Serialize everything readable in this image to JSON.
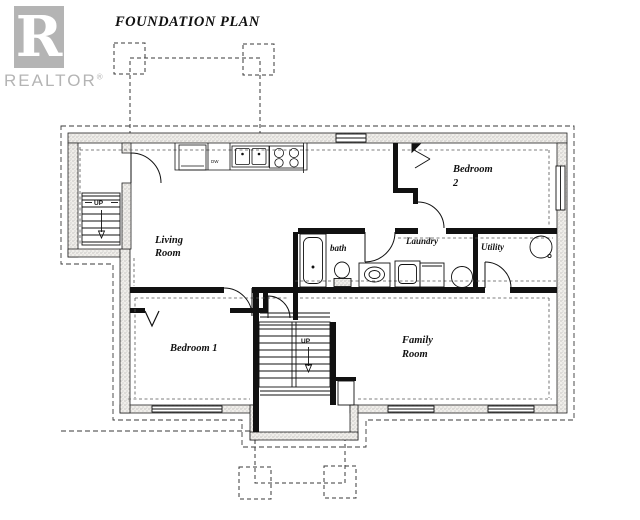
{
  "title": "FOUNDATION PLAN",
  "logo": {
    "letter": "R",
    "brand": "REALTOR",
    "registered": "®"
  },
  "labels": {
    "living_line1": "Living",
    "living_line2": "Room",
    "bedroom2_line1": "Bedroom",
    "bedroom2_line2": "2",
    "bath": "bath",
    "laundry": "Laundry",
    "utility": "Utility",
    "bedroom1": "Bedroom 1",
    "family_line1": "Family",
    "family_line2": "Room",
    "up_left": "UP",
    "up_center": "UP",
    "dw": "DW"
  },
  "colors": {
    "ink": "#1a1a1a",
    "logo_gray": "#b4b4b4",
    "paper": "#ffffff"
  }
}
